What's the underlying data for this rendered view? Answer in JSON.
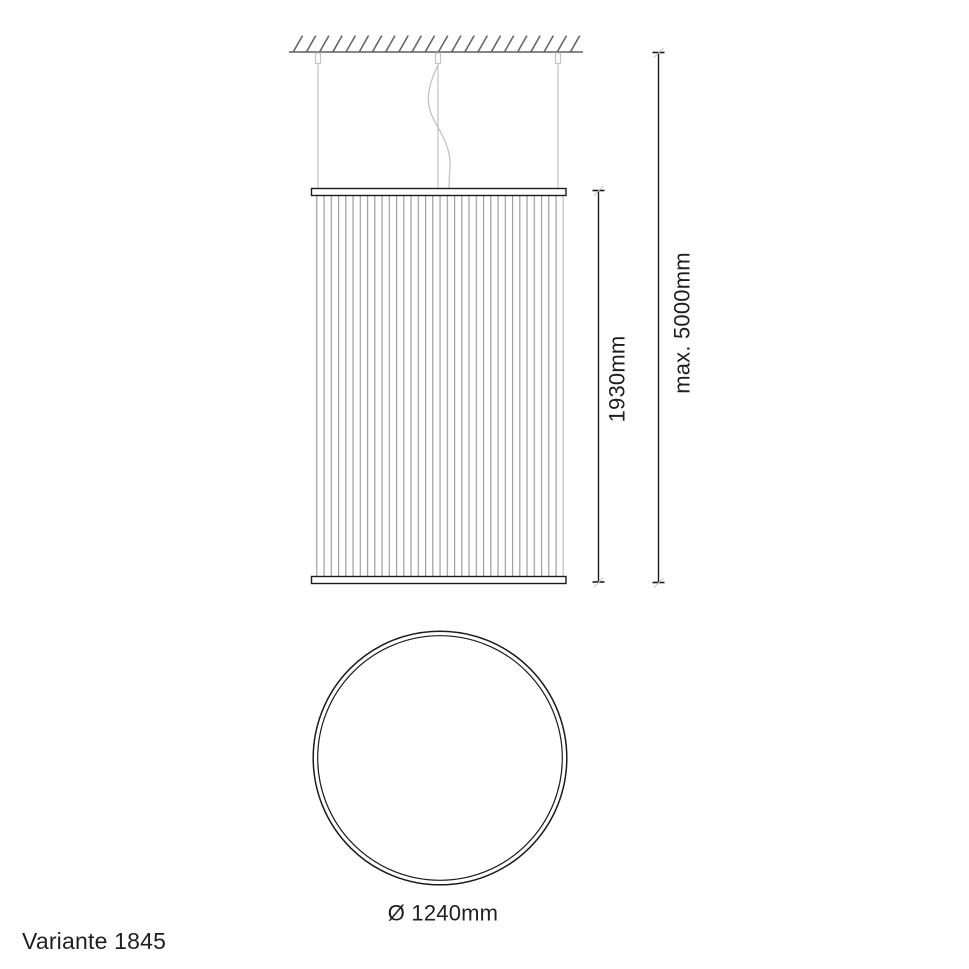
{
  "labels": {
    "variant": "Variante 1845",
    "shade_height": "1930mm",
    "max_suspension": "max. 5000mm",
    "diameter": "Ø 1240mm"
  },
  "colors": {
    "line": "#1c1c1c",
    "text": "#1f1f1f",
    "pleat": "#9e9e9e",
    "cable": "#c3c3c3",
    "ceiling": "#5e5e5e",
    "tick_slash": "#c9c9c9",
    "background": "#ffffff"
  }
}
